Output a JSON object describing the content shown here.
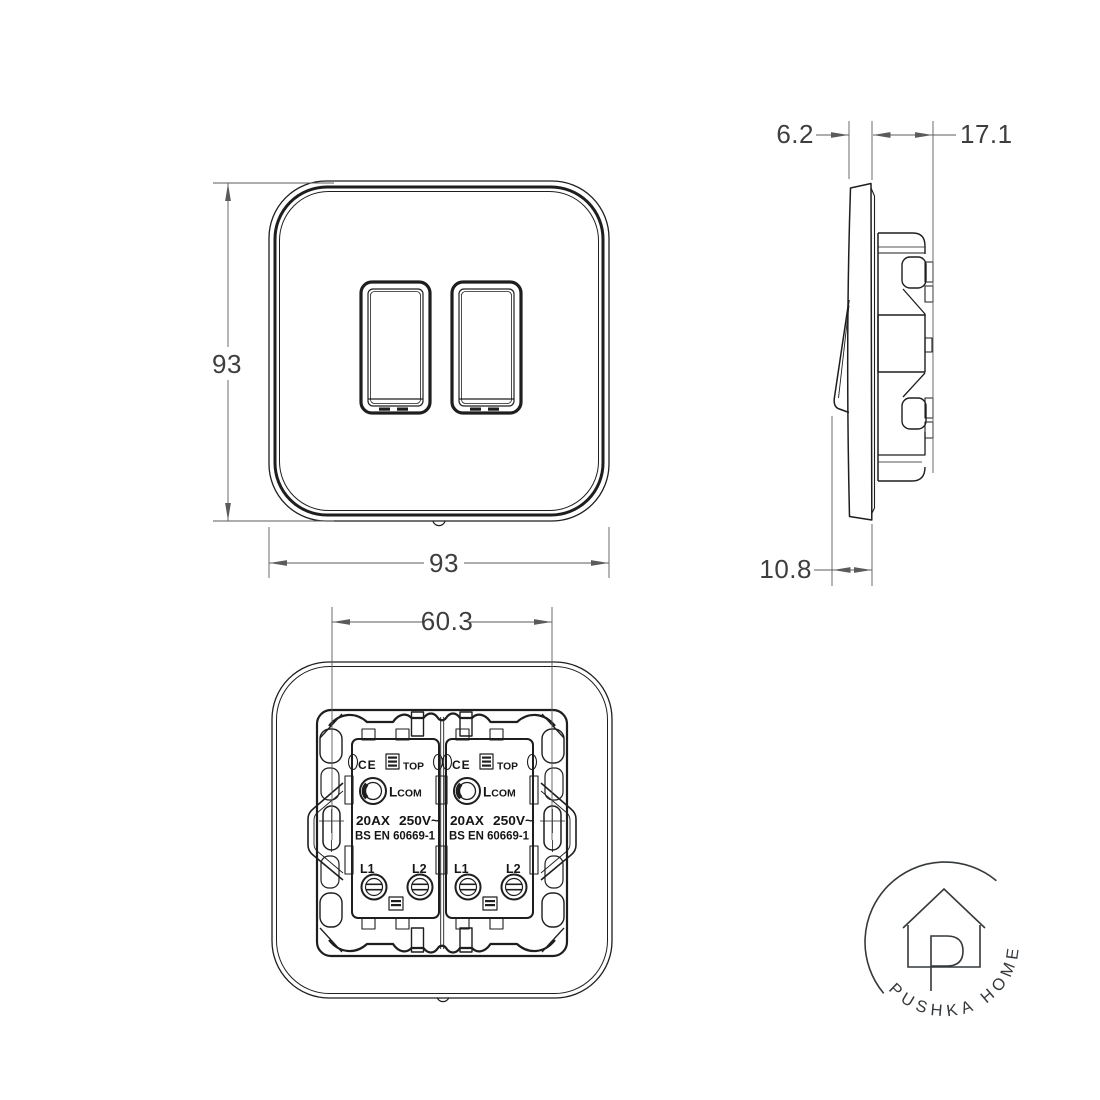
{
  "document": {
    "background": "#ffffff"
  },
  "drawing_colors": {
    "line": "#1e1e1e",
    "dimension": "#5b5b5b",
    "dimension_text": "#3e3e3e",
    "logo": "#35393c"
  },
  "views": {
    "front": {
      "height_dim": "93",
      "width_dim": "93"
    },
    "side": {
      "plate_thickness_dim": "6.2",
      "mechanism_depth_dim": "17.1",
      "switch_protrusion_dim": "10.8"
    },
    "back": {
      "fixing_centres_dim": "60.3",
      "module": {
        "ce_mark": "CE",
        "top_label": "TOP",
        "terminal_l": "L",
        "terminal_com": "COM",
        "rating_amps": "20AX",
        "rating_volts": "250V~",
        "standard": "BS EN 60669-1",
        "terminal_l1": "L1",
        "terminal_l2": "L2"
      }
    }
  },
  "logo": {
    "brand": "PUSHKA HOME"
  }
}
